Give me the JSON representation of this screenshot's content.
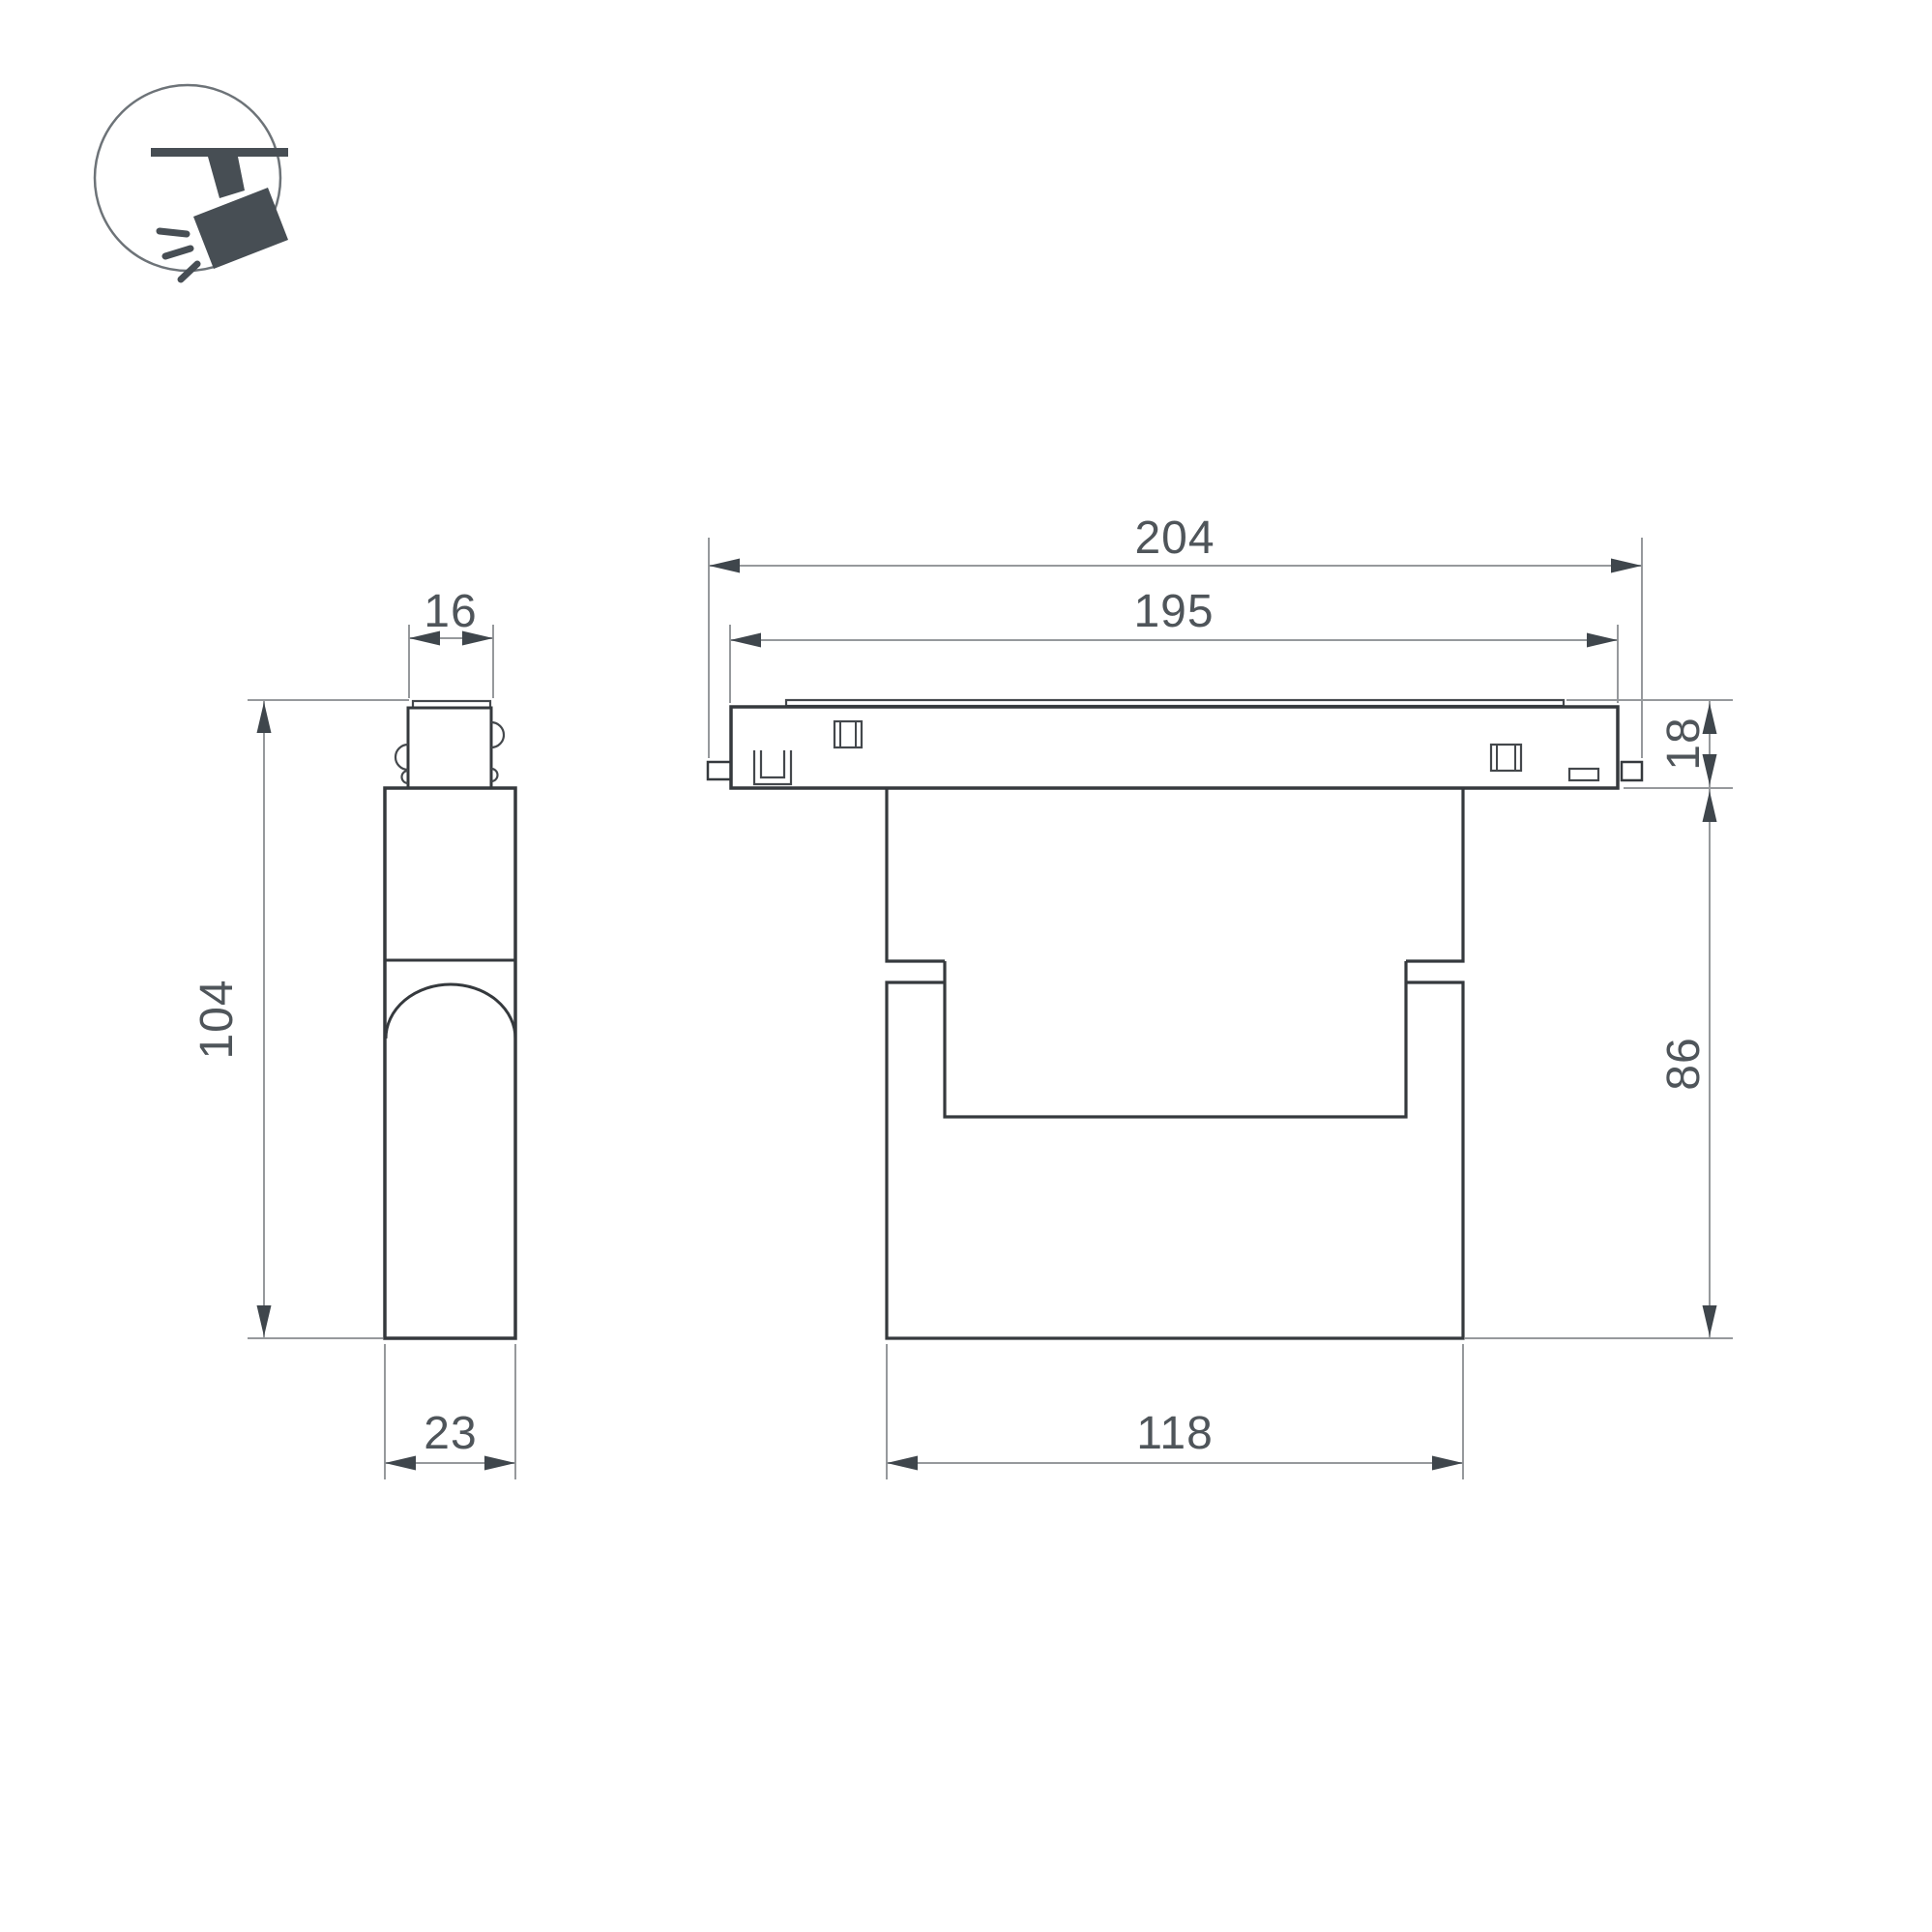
{
  "drawing": {
    "type": "technical-dimension-drawing",
    "product": "magnetic-track-spotlight",
    "icon": {
      "name": "track-spotlight-icon"
    },
    "colors": {
      "background": "#ffffff",
      "outline": "#35393d",
      "dimension_line": "#96999c",
      "arrow": "#3f464c",
      "dimension_text": "#4f555a",
      "icon_fill": "#474e54"
    },
    "views": {
      "side": {
        "dims": {
          "top_width": "16",
          "height": "104",
          "bottom_width": "23"
        }
      },
      "front": {
        "dims": {
          "total_width": "204",
          "inner_width": "195",
          "track_height": "18",
          "body_height": "86",
          "body_width": "118"
        }
      }
    }
  }
}
